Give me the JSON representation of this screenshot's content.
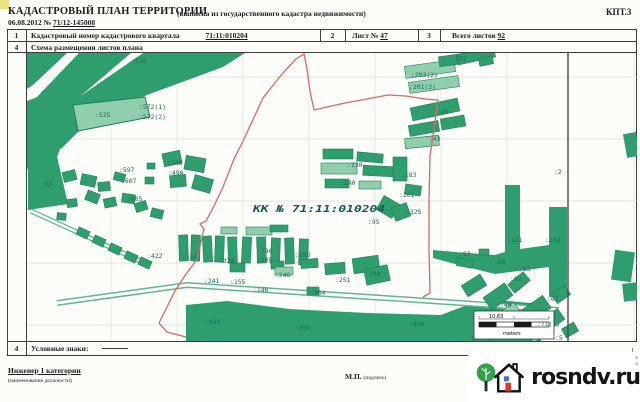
{
  "header": {
    "title": "КАДАСТРОВЫЙ ПЛАН ТЕРРИТОРИИ",
    "subtitle": "(выписка из государственного кадастра недвижимости)",
    "doc_code": "КПТ.3",
    "date_prefix": "06.08.2012 №",
    "date_number": "71/12-145008"
  },
  "info_table": {
    "row1": {
      "num1": "1",
      "label1": "Кадастровый номер кадастрового квартала",
      "value1": "71:11:010204",
      "num2": "2",
      "label2": "Лист №",
      "value2": "47",
      "num3": "3",
      "label3": "Всего листов",
      "value3": "92"
    },
    "row2": {
      "num": "4",
      "label": "Схема размещения листов плана"
    },
    "legend_row": {
      "num": "4",
      "label": "Условные знаки:"
    }
  },
  "map": {
    "quarter_label": "КК № 71:11:010204",
    "scale_bar": {
      "value": "10,63",
      "unit": "meters"
    },
    "parcels": [
      {
        "t": ":578",
        "x": 104,
        "y": 10
      },
      {
        "t": ":525",
        "x": 68,
        "y": 64
      },
      {
        "t": ":572(1)",
        "x": 112,
        "y": 56
      },
      {
        "t": ":572(2)",
        "x": 112,
        "y": 66
      },
      {
        "t": ":69",
        "x": 14,
        "y": 133
      },
      {
        "t": ":597",
        "x": 92,
        "y": 119
      },
      {
        "t": ":607",
        "x": 94,
        "y": 130
      },
      {
        "t": ":605",
        "x": 100,
        "y": 148
      },
      {
        "t": ":348",
        "x": 140,
        "y": 112
      },
      {
        "t": ":490",
        "x": 141,
        "y": 122
      },
      {
        "t": ":422",
        "x": 120,
        "y": 205
      },
      {
        "t": "152",
        "x": 428,
        "y": 8
      },
      {
        "t": ":203(2)",
        "x": 384,
        "y": 24
      },
      {
        "t": ":201(2)",
        "x": 382,
        "y": 36
      },
      {
        "t": ":45",
        "x": 410,
        "y": 61
      },
      {
        "t": ":43",
        "x": 402,
        "y": 88
      },
      {
        "t": ":130",
        "x": 320,
        "y": 114
      },
      {
        "t": ":140",
        "x": 313,
        "y": 132
      },
      {
        "t": ":183",
        "x": 374,
        "y": 124
      },
      {
        "t": ":261",
        "x": 372,
        "y": 144
      },
      {
        "t": ":325",
        "x": 379,
        "y": 161
      },
      {
        "t": ":95",
        "x": 341,
        "y": 171
      },
      {
        "t": ":2",
        "x": 527,
        "y": 121
      },
      {
        "t": ":151",
        "x": 155,
        "y": 206
      },
      {
        "t": ":320",
        "x": 192,
        "y": 210
      },
      {
        "t": ":196",
        "x": 230,
        "y": 200
      },
      {
        "t": ":105",
        "x": 230,
        "y": 209
      },
      {
        "t": ":193",
        "x": 268,
        "y": 204
      },
      {
        "t": ":241",
        "x": 177,
        "y": 230
      },
      {
        "t": ":155",
        "x": 203,
        "y": 231
      },
      {
        "t": ":246",
        "x": 248,
        "y": 224
      },
      {
        "t": ":251",
        "x": 308,
        "y": 229
      },
      {
        "t": ":194",
        "x": 338,
        "y": 223
      },
      {
        "t": ":146",
        "x": 226,
        "y": 239
      },
      {
        "t": ":204",
        "x": 283,
        "y": 242
      },
      {
        "t": ":92",
        "x": 432,
        "y": 203
      },
      {
        "t": ":98",
        "x": 467,
        "y": 211
      },
      {
        "t": ":141",
        "x": 480,
        "y": 189
      },
      {
        "t": ":142",
        "x": 518,
        "y": 189
      },
      {
        "t": ":63",
        "x": 492,
        "y": 218
      },
      {
        "t": ":62",
        "x": 483,
        "y": 228
      },
      {
        "t": ":67",
        "x": 520,
        "y": 248
      },
      {
        "t": ":48",
        "x": 473,
        "y": 254
      },
      {
        "t": ":71(1)",
        "x": 510,
        "y": 273
      },
      {
        "t": ":5",
        "x": 528,
        "y": 287
      },
      {
        "t": ":454",
        "x": 178,
        "y": 271
      },
      {
        "t": ":450",
        "x": 268,
        "y": 277
      },
      {
        "t": ":456",
        "x": 382,
        "y": 273
      }
    ],
    "edge_mark_top": "в",
    "edge_mark_bottom": "и"
  },
  "footer": {
    "position_title": "Инженер 1 категории",
    "position_caption": "(наименование должности)",
    "stamp": "М.П.",
    "stamp_caption": "(подпись)"
  },
  "watermark": {
    "text": "rosndv.ru"
  },
  "colors": {
    "parcel_green": "#2f9e6e",
    "parcel_light": "#8fcfae",
    "parcel_stroke": "#1f7c54",
    "boundary_red": "#d9695f",
    "label_green": "#1c6b52",
    "grid": "#d9e2da",
    "tree_green": "#2fa24c",
    "door_red": "#d63b30",
    "window_blue": "#3a6fd8"
  }
}
